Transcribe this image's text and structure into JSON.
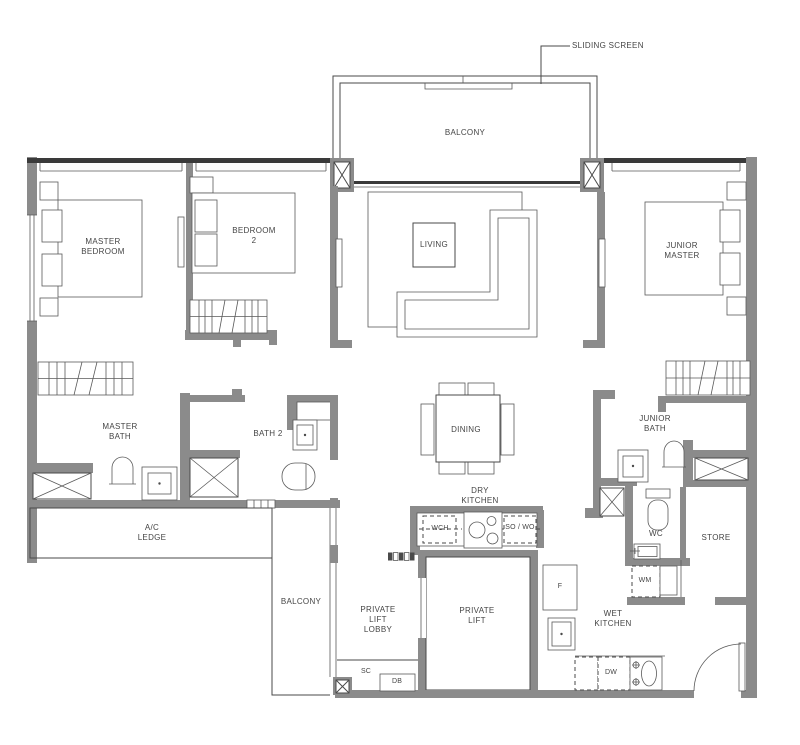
{
  "plan": {
    "annotations": {
      "sliding_screen": "SLIDING SCREEN"
    },
    "rooms": {
      "balcony_top": "BALCONY",
      "master_bedroom": "MASTER\nBEDROOM",
      "bedroom_2": "BEDROOM\n2",
      "living": "LIVING",
      "junior_master": "JUNIOR\nMASTER",
      "master_bath": "MASTER\nBATH",
      "bath_2": "BATH 2",
      "dining": "DINING",
      "junior_bath": "JUNIOR\nBATH",
      "ac_ledge": "A/C\nLEDGE",
      "dry_kitchen": "DRY\nKITCHEN",
      "wc": "WC",
      "store": "STORE",
      "balcony_bottom": "BALCONY",
      "private_lift_lobby": "PRIVATE\nLIFT\nLOBBY",
      "private_lift": "PRIVATE\nLIFT",
      "wet_kitchen": "WET\nKITCHEN"
    },
    "appliances": {
      "wch": "WCH",
      "so_wo": "SO / WO",
      "f": "F",
      "wm": "WM",
      "sc": "SC",
      "db": "DB",
      "dw": "DW"
    },
    "colors": {
      "wall": "#8b8b8b",
      "line": "#4a4a4a",
      "text": "#454545",
      "background": "#ffffff"
    }
  }
}
